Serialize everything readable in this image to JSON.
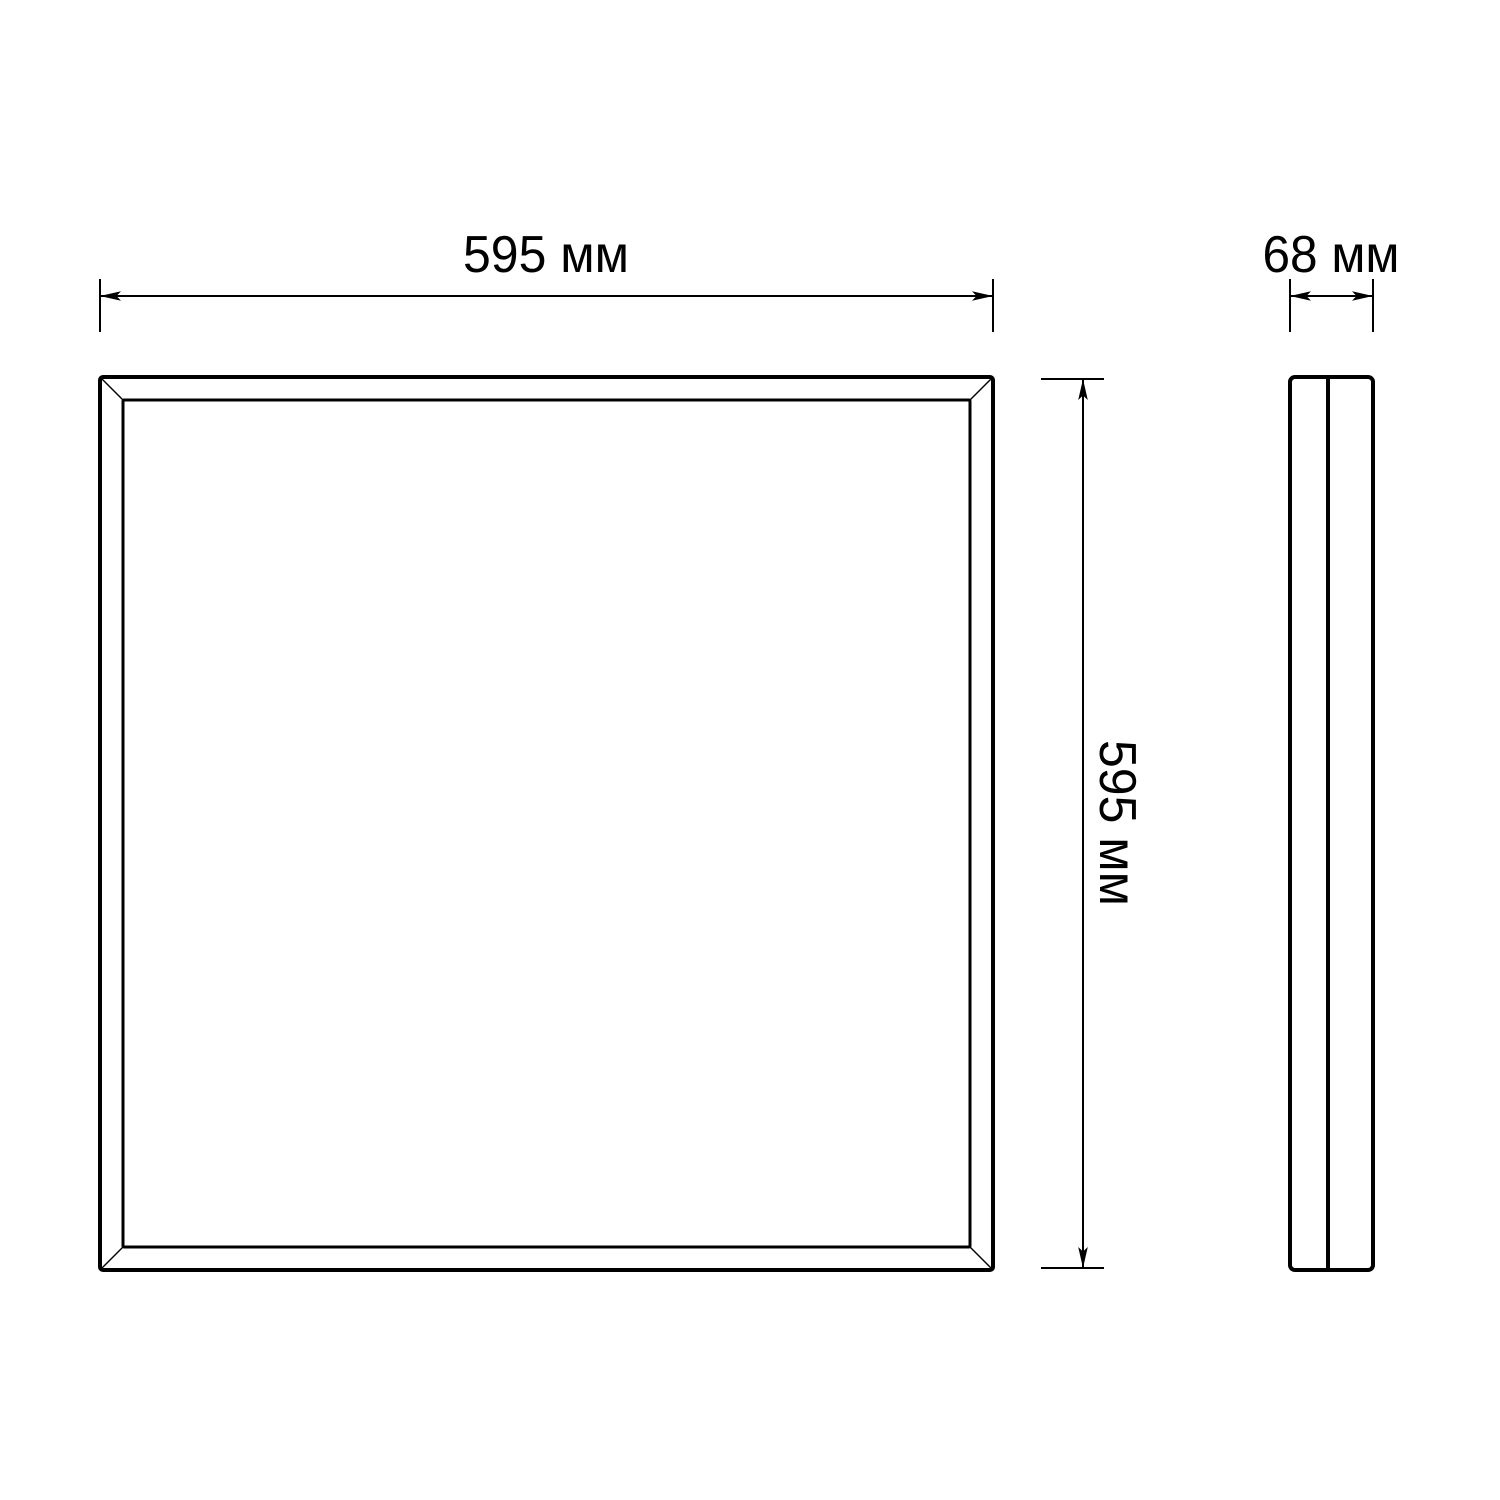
{
  "drawing": {
    "unit": "мм",
    "line_color": "#000000",
    "background_color": "#ffffff",
    "views": {
      "front": {
        "width_value": 595,
        "width_label": "595 мм",
        "height_value": 595,
        "height_label": "595 мм"
      },
      "side": {
        "depth_value": 68,
        "depth_label": "68 мм"
      }
    }
  }
}
